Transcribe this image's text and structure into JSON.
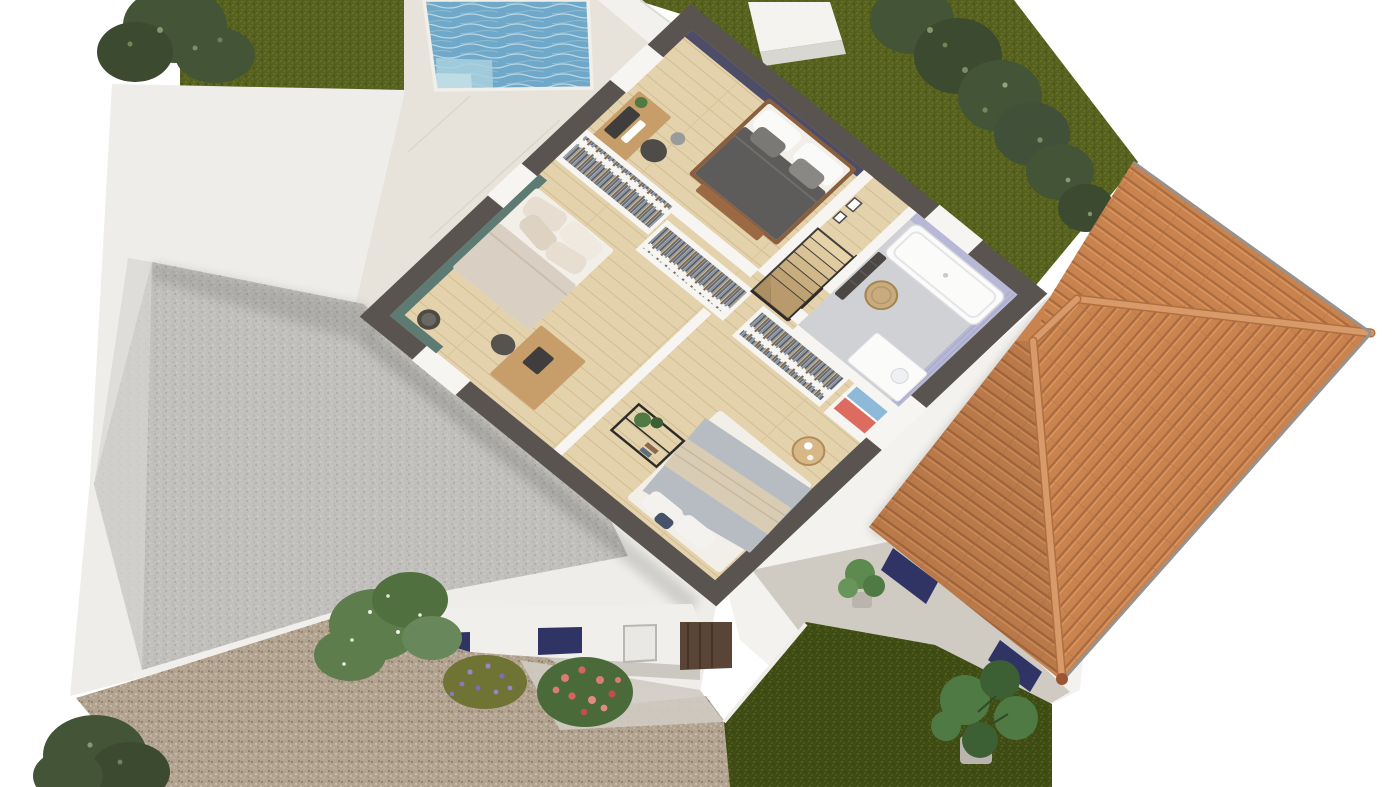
{
  "meta": {
    "title": "3D cutaway floor plan render — upper floor of a villa",
    "view": "isometric top-down",
    "text_on_screen": "none"
  },
  "palette": {
    "bg": "#ffffff",
    "lawn": "#57621f",
    "lawn_dark": "#3f4c14",
    "tree": "#445437",
    "tree_light": "#93ab7c",
    "pool": "#6fa8c8",
    "pool_step": "#a8d0de",
    "coping": "#f1efe9",
    "white_mass": "#efede9",
    "patio": "#e7e3db",
    "court_gravel": "#c2c0bc",
    "drive_gravel": "#b2a390",
    "path": "#cfcbc3",
    "cut_wall": "#595450",
    "inner_wall": "#f6f5f2",
    "wood": "#e3d2ab",
    "navy": "#4d4d68",
    "teal": "#5e7b73",
    "lavender": "#b7b7d6",
    "bath_floor": "#d0d1d5",
    "tub": "#fbfbfa",
    "roof": "#c8834f",
    "ridge": "#d79a68",
    "eave": "#95928f",
    "shutter": "#2f3465",
    "door_wood": "#5a4435",
    "bed1_duvet": "#5d5c5a",
    "bed1_frame": "#8a5f3e",
    "mattress": "#f2efe9",
    "bed2_duvet": "#d9cfc2",
    "bed3_duvet": "#b6bcc2",
    "knit": "#d9ccb4",
    "desk_wood": "#c79e69",
    "black_metal": "#2e2c2a",
    "radiator": "#4b4744",
    "plant": "#4f7a43",
    "plant_dark": "#3c5f33",
    "flower_pink": "#d97b76",
    "flower_purple": "#9486c8",
    "linen_red": "#dd6b5f",
    "linen_blue": "#8fb9d9",
    "basket": "#c8ab7e",
    "stair_pit": "#403c38"
  },
  "scene": {
    "garden": {
      "upper_lawn": {
        "label": "upper lawn"
      },
      "hedge": {
        "label": "hedge of shrubs along boundary"
      },
      "pool": {
        "label": "swimming pool with corner steps"
      },
      "pool_deck": {
        "label": "stone pool deck"
      },
      "lower_lawn": {
        "label": "lower lawn"
      }
    },
    "courtyard": {
      "label": "walled gravel courtyard"
    },
    "driveway": {
      "label": "gravel driveway with concrete path"
    },
    "flower_bed": {
      "items": [
        "climbing jasmine",
        "lavender bush",
        "rose bush"
      ]
    },
    "house": {
      "label": "upper-floor cutaway (dark cut walls)",
      "rooms": [
        {
          "id": "bedroom-1",
          "label": "master bedroom",
          "accent": "#4d4d68",
          "furniture": [
            "double bed",
            "desk with monitor",
            "office chair",
            "pendant lamp"
          ]
        },
        {
          "id": "dressing",
          "label": "dressing corridor",
          "furniture": [
            "wardrobe row 1",
            "wardrobe row 2",
            "wardrobe row 3",
            "linen shelves (red & blue)"
          ]
        },
        {
          "id": "landing",
          "label": "landing with staircase",
          "furniture": [
            "wood stairs",
            "black railing",
            "picture frames"
          ]
        },
        {
          "id": "bathroom",
          "label": "bathroom",
          "accent": "#b7b7d6",
          "furniture": [
            "bathtub",
            "vanity",
            "towel radiator",
            "wicker basket"
          ]
        },
        {
          "id": "bedroom-2",
          "label": "bedroom 2",
          "accent": "#5e7b73",
          "furniture": [
            "double bed",
            "desk",
            "chair",
            "stool"
          ]
        },
        {
          "id": "bedroom-3",
          "label": "bedroom 3",
          "furniture": [
            "double bed with knit throw",
            "black console shelf",
            "round side table"
          ]
        }
      ]
    },
    "garage": {
      "label": "garage wing",
      "roof": {
        "label": "terracotta hip roof with ridge tiles"
      },
      "shutters": "#2f3465",
      "patio": {
        "label": "side terrace"
      },
      "plants": [
        "monstera",
        "potted shrub"
      ]
    }
  }
}
